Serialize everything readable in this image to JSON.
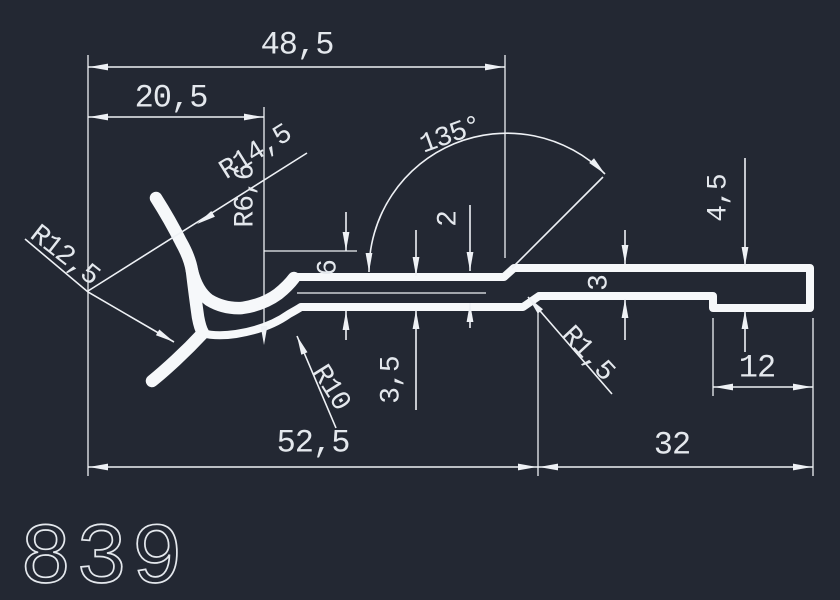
{
  "drawing": {
    "part_number": "839",
    "background_color": "#232833",
    "line_color": "#eef1f5",
    "text_color": "#e4e8ed",
    "profile_color": "#f6f8fa",
    "dimensions": {
      "total_width": "48,5",
      "hook_offset": "20,5",
      "bend_angle": "135°",
      "radius_outer_hook": "R14,5",
      "radius_pocket": "R6,6",
      "radius_claw": "R12,5",
      "radius_bottom_fillet": "R10",
      "radius_step_fillet": "R1,5",
      "step_height": "2",
      "pocket_depth": "6",
      "web_thickness": "3,5",
      "flange_thickness": "3",
      "end_height": "4,5",
      "end_length": "12",
      "body_length": "52,5",
      "flange_length": "32"
    }
  }
}
